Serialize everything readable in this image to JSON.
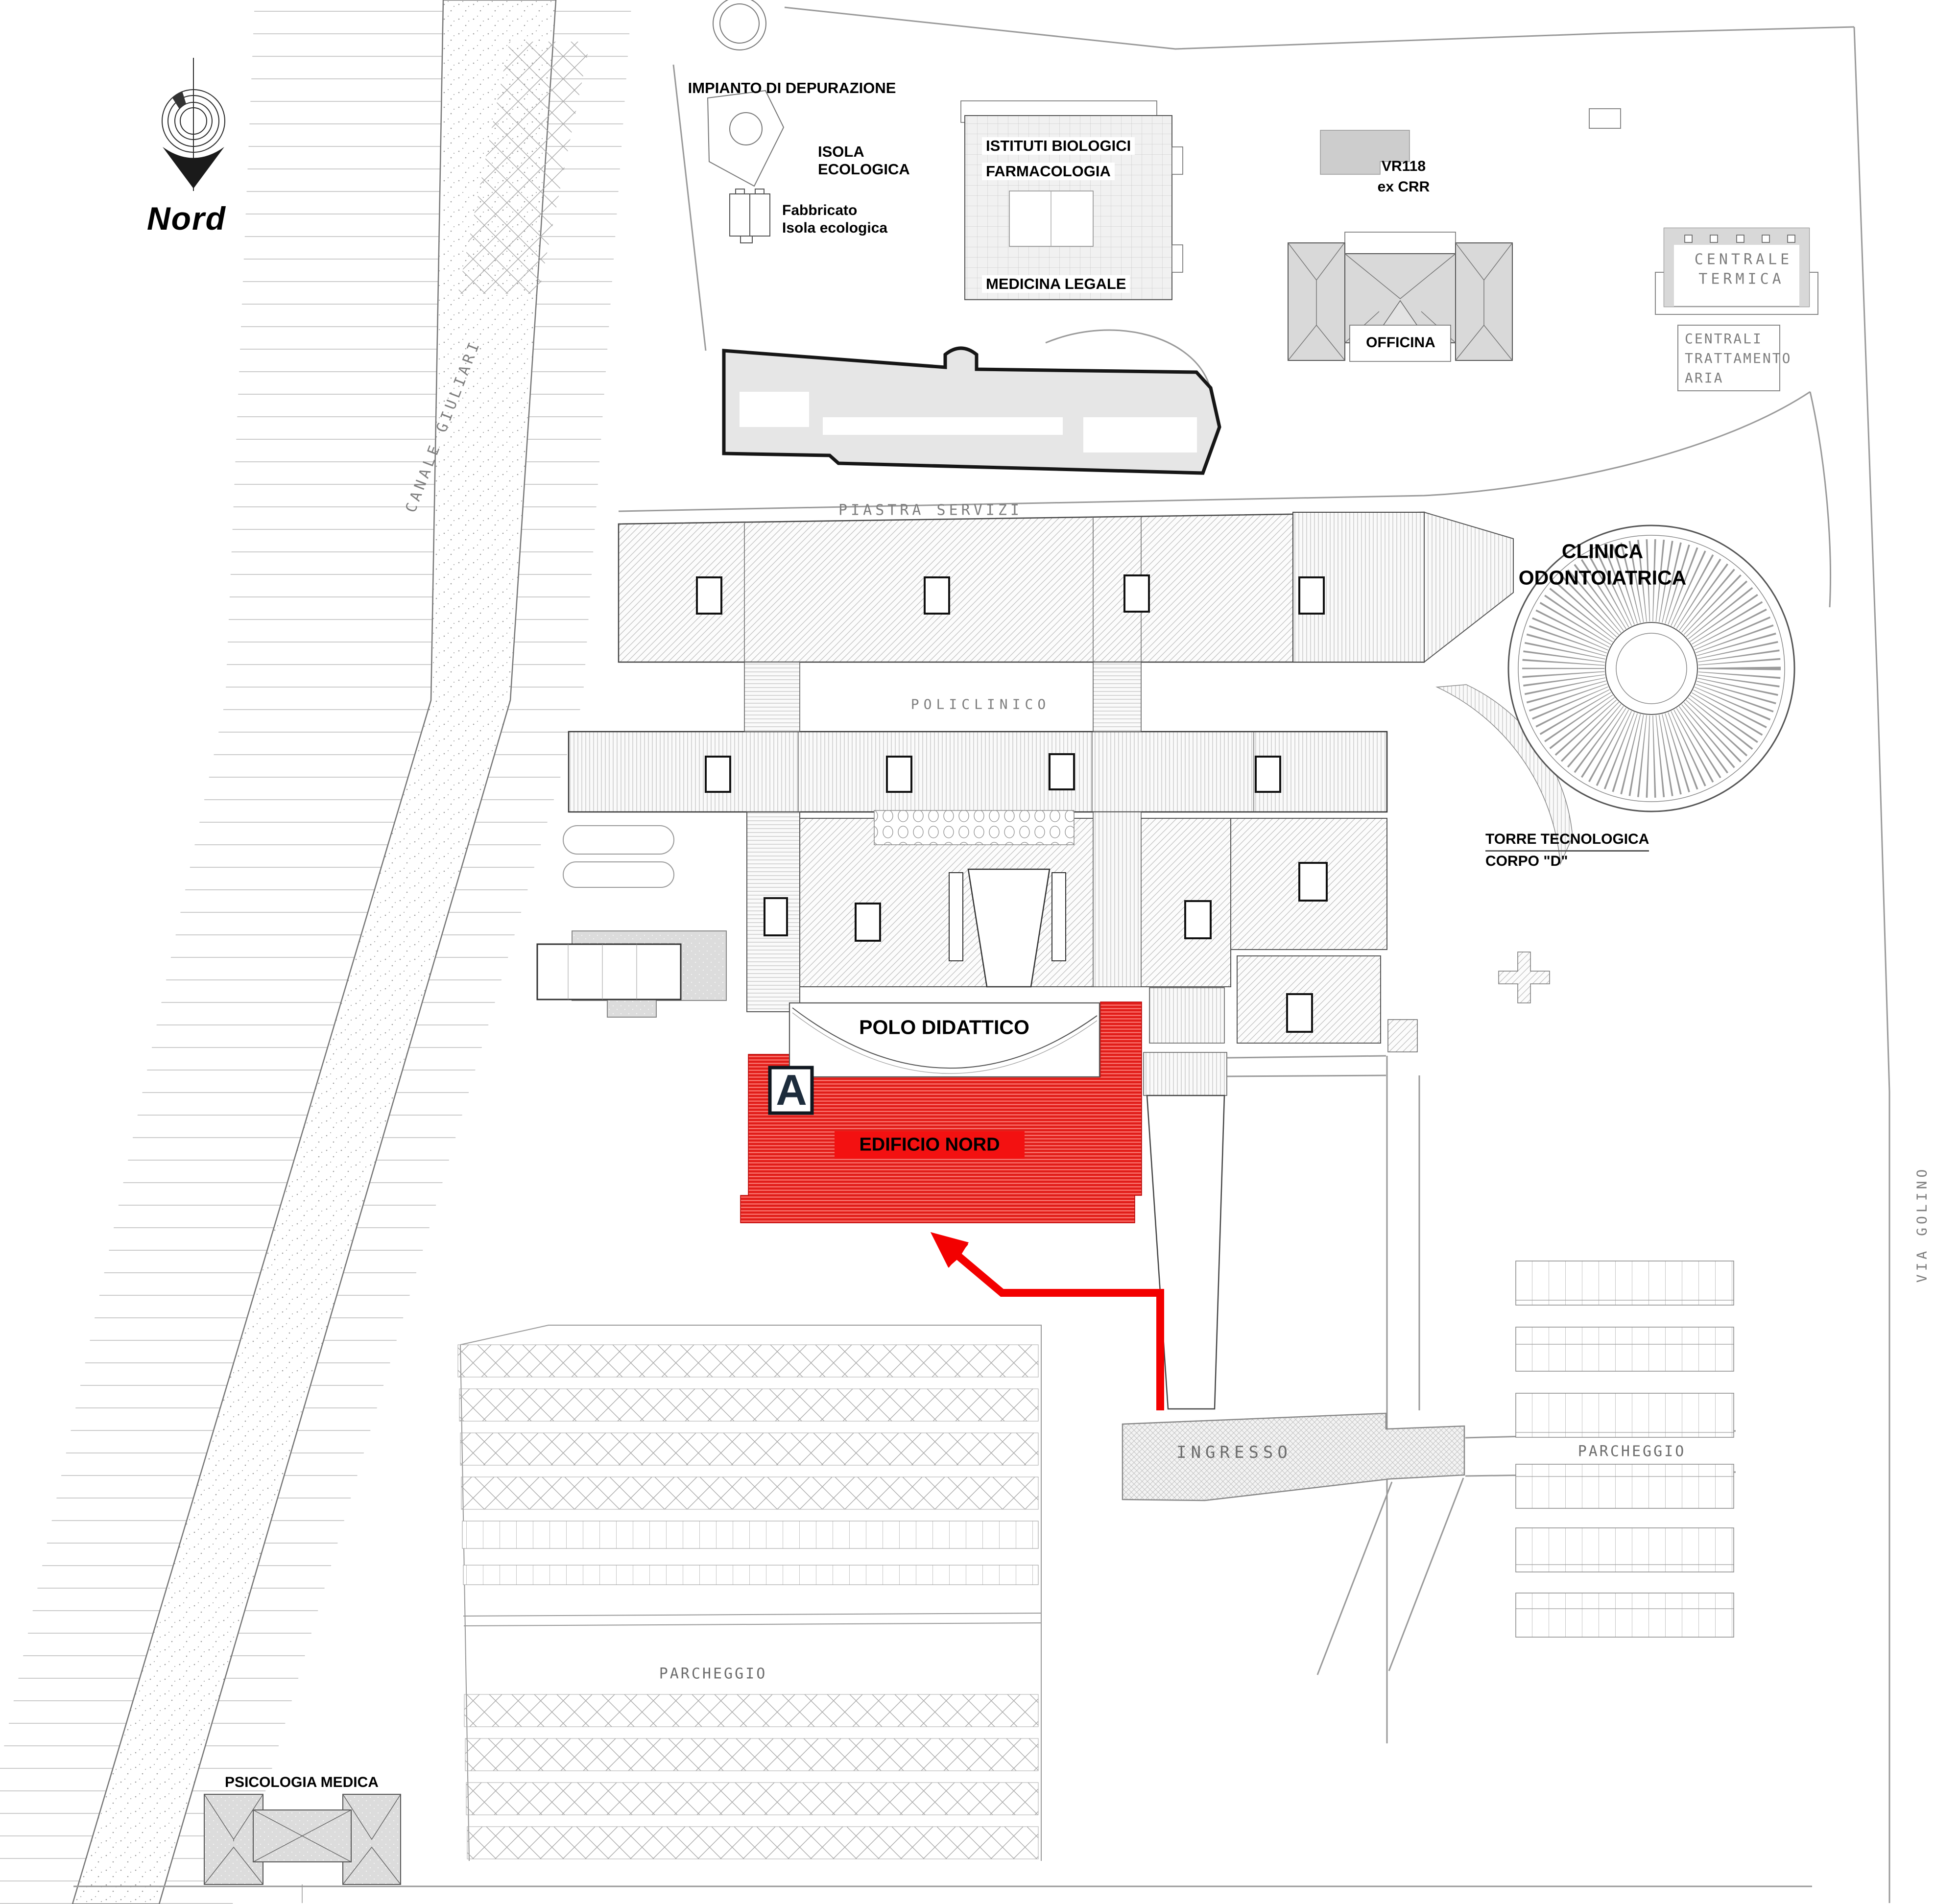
{
  "compass": {
    "label": "Nord"
  },
  "colors": {
    "highlight_red": "#ec2420",
    "label_red_bg": "#f31111",
    "arrow_red": "#f30000",
    "building_gray": "#dcdcdc",
    "line_gray": "#999999",
    "tech_text_gray": "#7e7e7e",
    "marker_letter_color": "#1d2c3c"
  },
  "buildings": {
    "impianto_depurazione": "IMPIANTO DI DEPURAZIONE",
    "isola_ecologica": {
      "line1": "ISOLA",
      "line2": "ECOLOGICA"
    },
    "fabbricato": {
      "line1": "Fabbricato",
      "line2": "Isola ecologica"
    },
    "istituti_biologici": "ISTITUTI BIOLOGICI",
    "farmacologia": "FARMACOLOGIA",
    "medicina_legale": "MEDICINA LEGALE",
    "vr118": {
      "line1": "VR118",
      "line2": "ex CRR"
    },
    "officina": "OFFICINA",
    "centrale_termica": {
      "line1": "CENTRALE",
      "line2": "TERMICA"
    },
    "centrali_trattamento_aria": {
      "line1": "CENTRALI",
      "line2": "TRATTAMENTO",
      "line3": "ARIA"
    },
    "piastra_servizi": "PIASTRA SERVIZI",
    "clinica_odontoiatrica": {
      "line1": "CLINICA",
      "line2": "ODONTOIATRICA"
    },
    "policlinico": "POLICLINICO",
    "torre_tecnologica": {
      "line1": "TORRE TECNOLOGICA",
      "line2": "CORPO \"D\""
    },
    "polo_didattico": "POLO DIDATTICO",
    "psicologia_medica": "PSICOLOGIA MEDICA"
  },
  "highlight": {
    "building": "EDIFICIO NORD",
    "marker": "A"
  },
  "streets": {
    "canal": "CANALE GIULIARI",
    "via": "VIA GOLINO"
  },
  "areas": {
    "ingresso": "INGRESSO",
    "parcheggio_east": "PARCHEGGIO",
    "parcheggio_south": "PARCHEGGIO"
  }
}
